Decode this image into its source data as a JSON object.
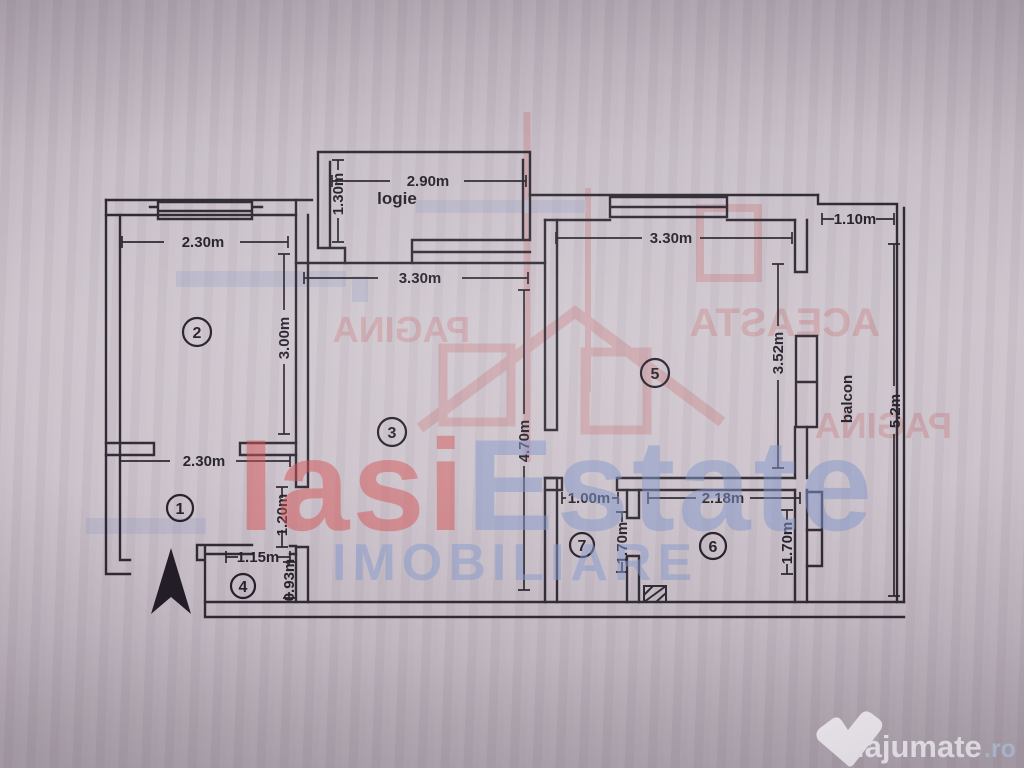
{
  "plan": {
    "labels": {
      "logie": "logie",
      "balcon": "balcon"
    },
    "rooms": {
      "r1": "1",
      "r2": "2",
      "r3": "3",
      "r4": "4",
      "r5": "5",
      "r6": "6",
      "r7": "7"
    },
    "dims": {
      "logie_width": "2.90m",
      "logie_depth": "1.30m",
      "room2_width": "2.30m",
      "room2_height": "3.00m",
      "room3_width": "3.30m",
      "room3_height": "4.70m",
      "hall_width": "2.30m",
      "hall_door": "1.20m",
      "room4_width": "1.15m",
      "room4_height": "0.93m",
      "room5_width": "3.30m",
      "room5_height": "3.52m",
      "room6_width": "2.18m",
      "room6_height": "1.70m",
      "room7_width": "1.00m",
      "room7_height": "1.70m",
      "balcon_width": "1.10m",
      "balcon_length": "5.2m"
    }
  },
  "watermark": {
    "brand_red": "Iasi",
    "brand_blue": "Estate",
    "brand_sub": "IMOBILIARE",
    "stamp_word1": "ACEASTA",
    "stamp_word2": "PAGINA",
    "colors": {
      "red": "#c24444",
      "blue": "#8095c5"
    }
  },
  "logo": {
    "name": "lajumate",
    "tld": ".ro"
  }
}
